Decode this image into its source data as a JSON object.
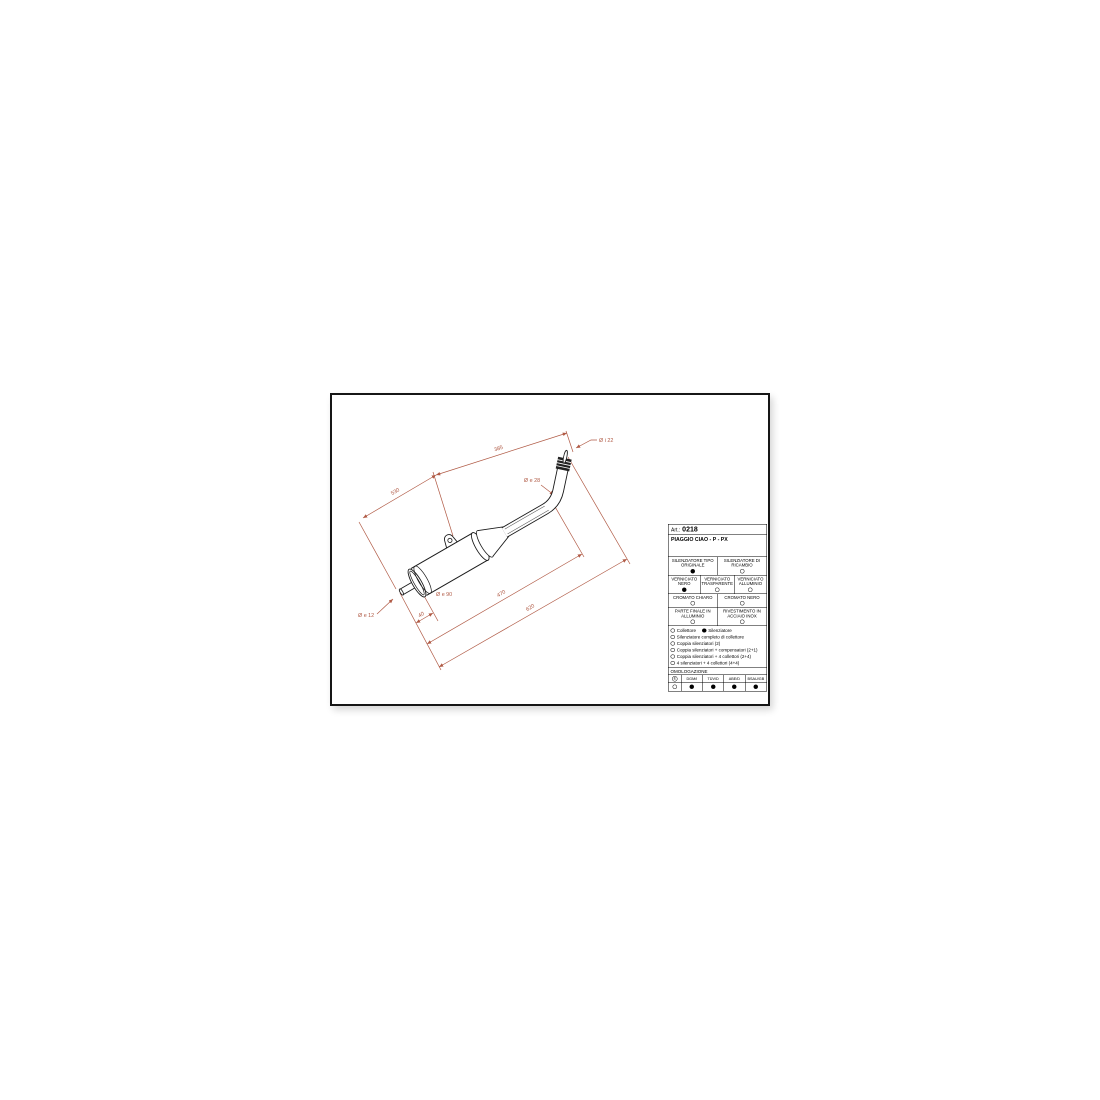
{
  "colors": {
    "dimension_line": "#b05a45",
    "drawing_line": "#1a1a1a",
    "paper": "#ffffff",
    "frame": "#161616"
  },
  "sheet": {
    "art_label": "Art.:",
    "art_number": "0218",
    "model": "PIAGGIO CIAO - P - PX"
  },
  "dimensions": {
    "pipe_length": "385",
    "silencer_length": "530",
    "inlet_diameter": "Ø i 22",
    "pipe_diameter": "Ø e 28",
    "body_diameter": "Ø e 90",
    "tail_diameter": "Ø e 12",
    "tail_length": "40",
    "mid_length": "470",
    "overall_length": "620"
  },
  "options": {
    "rows": [
      {
        "cells": [
          {
            "label": "SILENZIATORE TIPO ORIGINALE",
            "state": "filled"
          },
          {
            "label": "SILENZIATORE DI RICAMBIO",
            "state": "empty"
          }
        ]
      },
      {
        "cells": [
          {
            "label": "VERNICIATO NERO",
            "state": "filled"
          },
          {
            "label": "VERNICIATO TRASPARENTE",
            "state": "empty"
          },
          {
            "label": "VERNICIATO ALLUMINIO",
            "state": "empty"
          }
        ]
      },
      {
        "cells": [
          {
            "label": "CROMATO CHIARO",
            "state": "empty"
          },
          {
            "label": "CROMATO NERO",
            "state": "empty"
          }
        ]
      },
      {
        "cells": [
          {
            "label": "PARTE FINALE IN ALLUMINIO",
            "state": "empty"
          },
          {
            "label": "RIVESTIMENTO IN ACCIAIO INOX",
            "state": "empty"
          }
        ]
      }
    ]
  },
  "checklist": {
    "lines": [
      {
        "items": [
          {
            "label": "Collettore",
            "state": "empty"
          },
          {
            "label": "Silenziatore",
            "state": "filled"
          }
        ]
      },
      {
        "items": [
          {
            "label": "Silenziatore completo di collettore",
            "state": "empty"
          }
        ]
      },
      {
        "items": [
          {
            "label": "Coppia silenziatori (2)",
            "state": "empty"
          }
        ]
      },
      {
        "items": [
          {
            "label": "Coppia silenziatori + compensatori (2+1)",
            "state": "empty"
          }
        ]
      },
      {
        "items": [
          {
            "label": "Coppia silenziatori + 4 collettori (2+4)",
            "state": "empty"
          }
        ]
      },
      {
        "items": [
          {
            "label": "4 silenziatori + 4 collettori (4+4)",
            "state": "empty"
          }
        ]
      }
    ]
  },
  "homologation": {
    "title": "OMOLOGAZIONE",
    "cols": [
      {
        "label": "E",
        "state": "empty"
      },
      {
        "label": "DGM/I",
        "state": "filled"
      },
      {
        "label": "TÜV/D",
        "state": "filled"
      },
      {
        "label": "ABE/D",
        "state": "filled"
      },
      {
        "label": "BSAU/GB",
        "state": "filled"
      }
    ]
  }
}
